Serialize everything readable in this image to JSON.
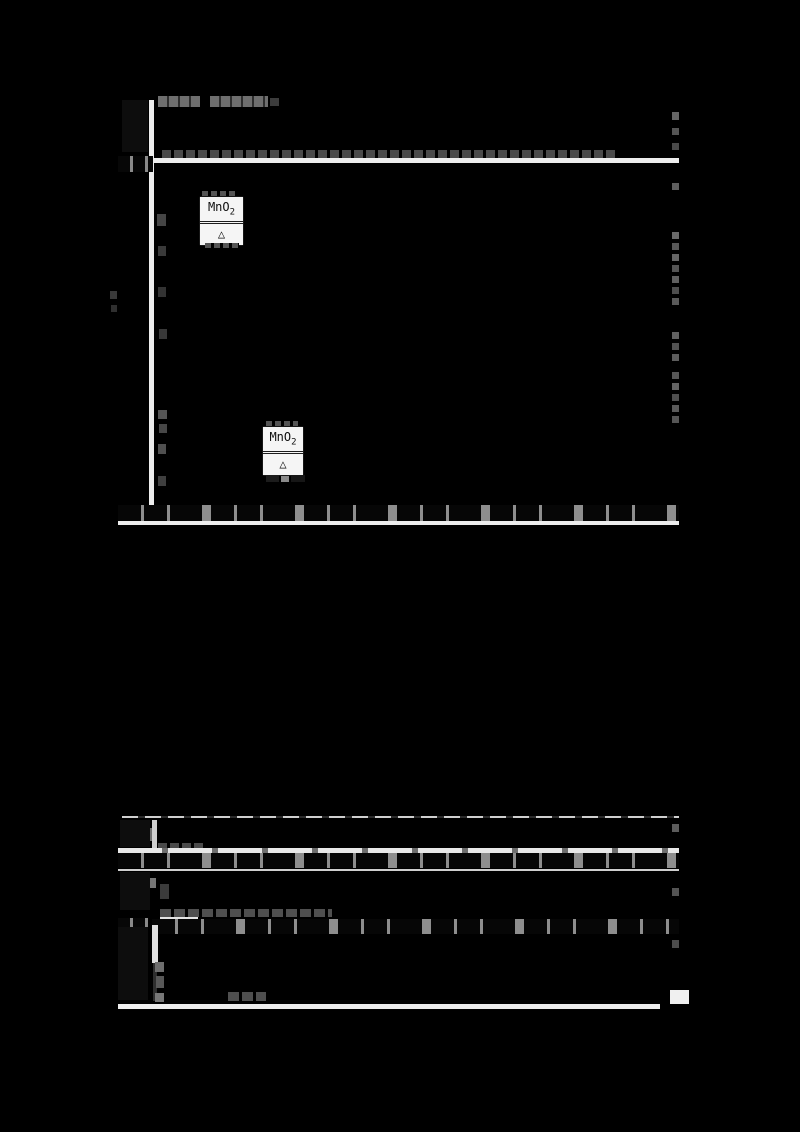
{
  "reaction_condition_boxes": [
    {
      "catalyst": "MnO",
      "catalyst_subscript": "2",
      "condition_symbol": "△"
    },
    {
      "catalyst": "MnO",
      "catalyst_subscript": "2",
      "condition_symbol": "△"
    }
  ],
  "colors": {
    "background": "#000000",
    "table_divider": "#ededed",
    "text_band_gray": "#8e8e8e",
    "condition_box_bg": "#f5f5f5",
    "condition_box_text": "#0e0e0e"
  }
}
